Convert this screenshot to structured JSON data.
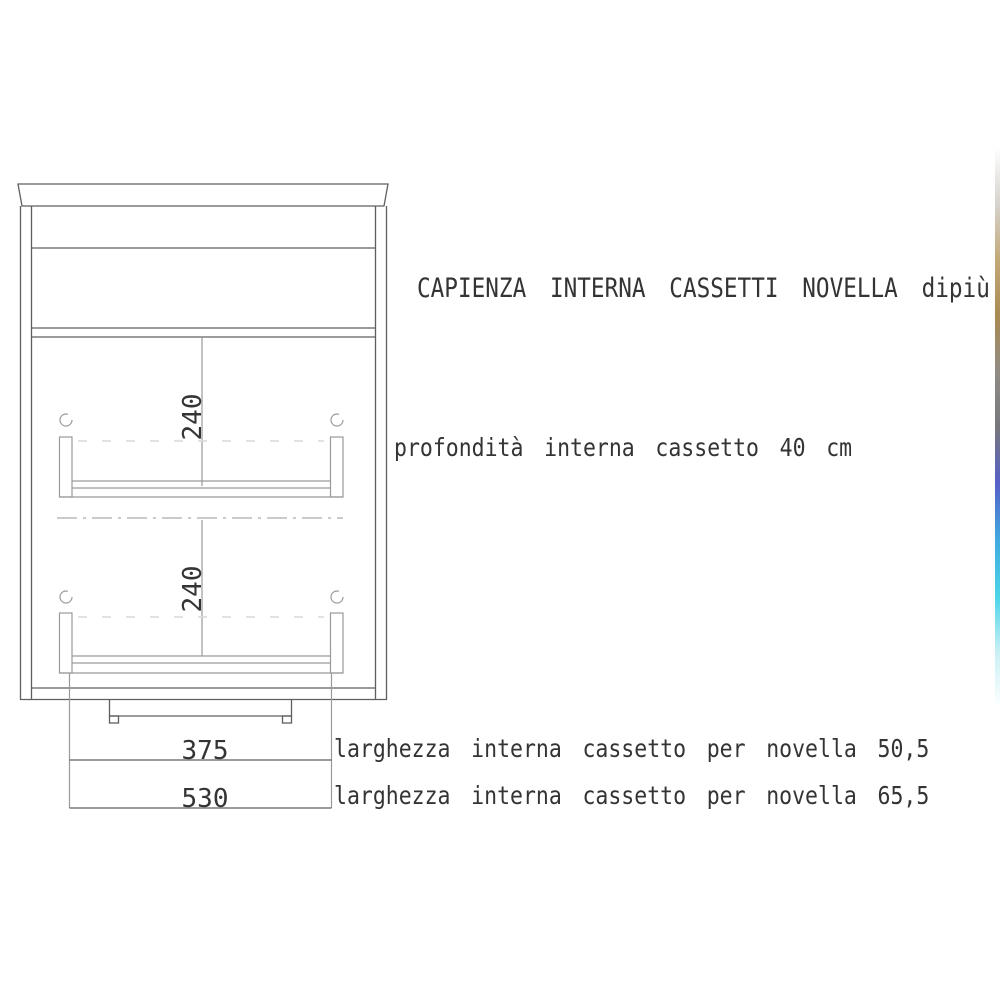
{
  "page": {
    "width": 1000,
    "height": 1000
  },
  "title": "CAPIENZA INTERNA CASSETTI NOVELLA dipiù",
  "annotations": {
    "depth_note": "profondità interna cassetto 40 cm",
    "width_note_novella_505": "larghezza interna cassetto per novella 50,5",
    "width_note_novella_655": "larghezza interna cassetto per novella 65,5"
  },
  "dimensions": {
    "drawer_top_height": "240",
    "drawer_bottom_height": "240",
    "inner_width_small": "375",
    "inner_width_large": "530"
  },
  "colors": {
    "line": "#5f5f5f",
    "line_light": "#9a9a9a",
    "line_faint": "#d9d9d9",
    "centerline": "#b8b8b8",
    "text": "#343434",
    "background": "#ffffff"
  },
  "artifact_strip": {
    "top": 148,
    "height": 560,
    "width": 5,
    "stops": [
      "rgba(216,214,211,0)",
      "#d6d3ce",
      "#c3a878",
      "#a98a52",
      "#908c85",
      "#77777c",
      "#5560c8",
      "#41a9e0",
      "#49d4e8",
      "#c9f0f4",
      "rgba(255,255,255,0)"
    ]
  }
}
